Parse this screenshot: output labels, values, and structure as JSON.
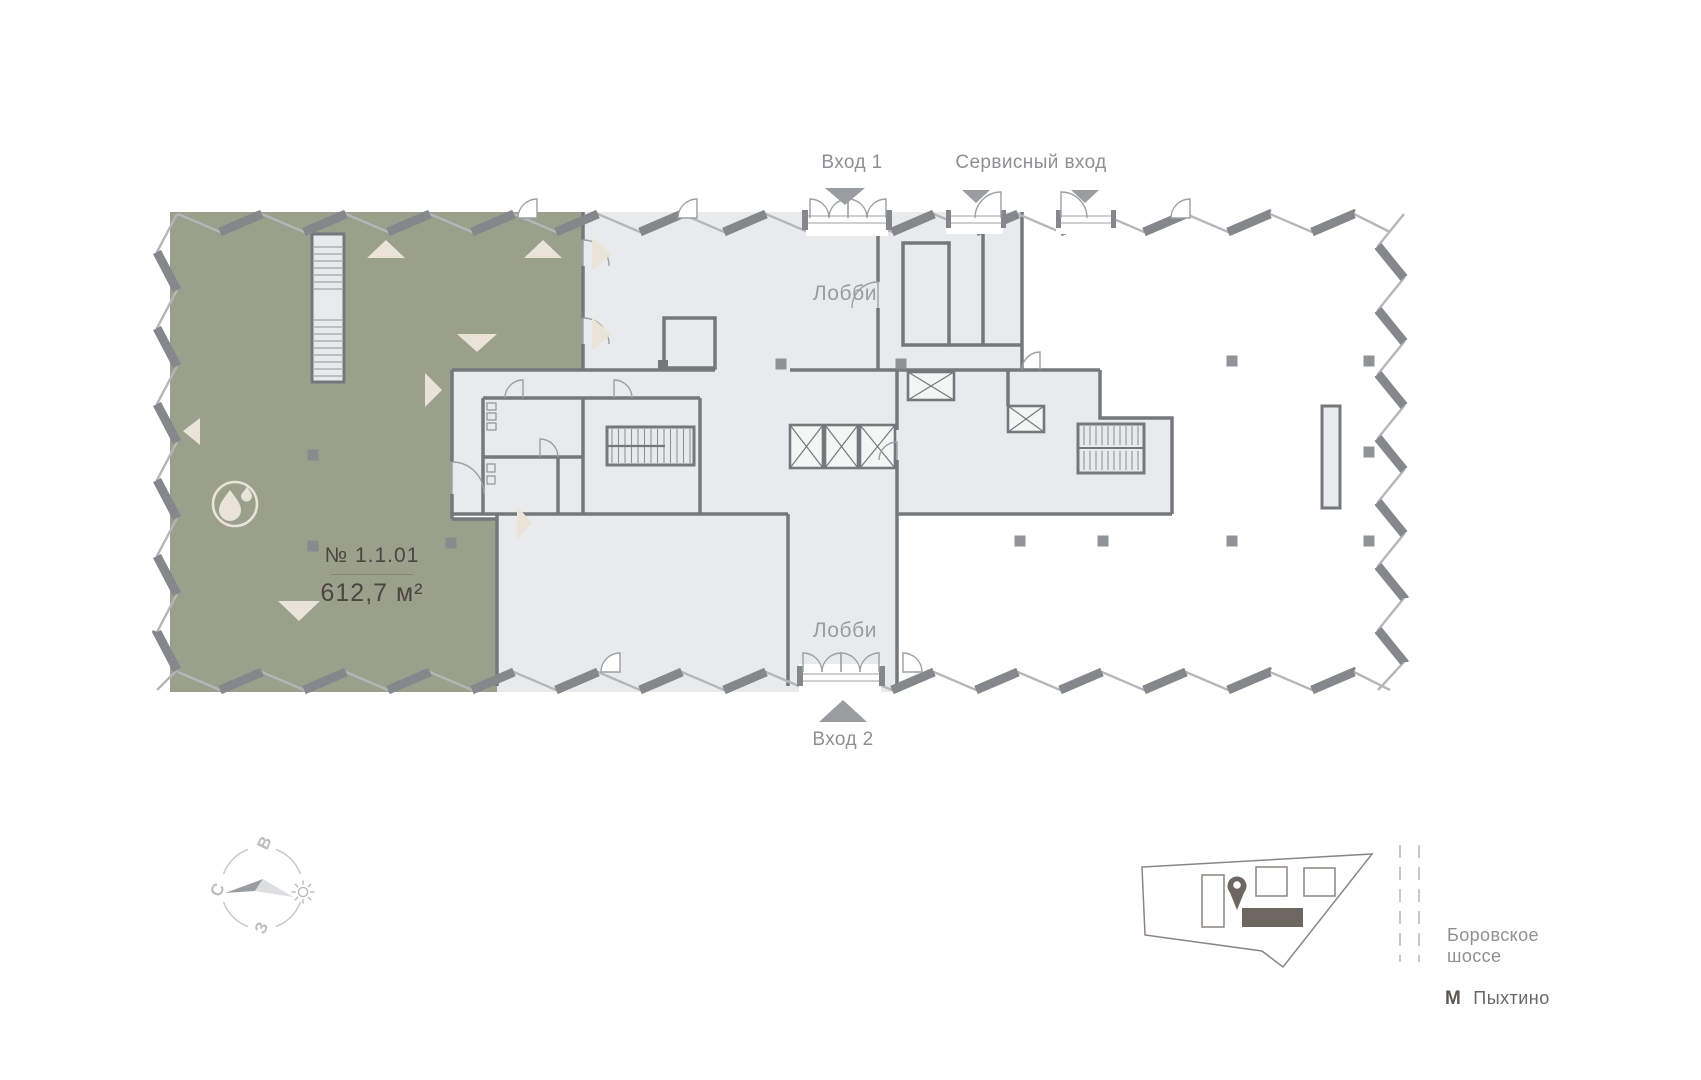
{
  "page": {
    "background": "#ffffff"
  },
  "colors": {
    "unit_fill": "#9aa08c",
    "room_fill": "#e9eaeb",
    "shaft_fill": "#f4f5f5",
    "wall": "#75787b",
    "facade_dark": "#85888b",
    "facade_light": "#b4b6b8",
    "accent_cream": "#e9e3d8",
    "label_gray": "#8d9093",
    "lobby_label_gray": "#9a9da0",
    "unit_text": "#4c463e",
    "minimap_dark": "#6e6760",
    "arrow_gray": "#9a9da0",
    "column": "#85888b"
  },
  "entrances": {
    "entrance1": "Вход 1",
    "service": "Сервисный вход",
    "entrance2": "Вход 2"
  },
  "rooms": {
    "lobby_upper": "Лобби",
    "lobby_lower": "Лобби"
  },
  "unit": {
    "number": "№ 1.1.01",
    "area": "612,7 м²"
  },
  "compass": {
    "north": "С",
    "east": "В",
    "west": "З"
  },
  "minimap": {
    "road_line1": "Боровское",
    "road_line2": "шоссе",
    "metro_symbol": "М",
    "metro_name": "Пыхтино"
  }
}
